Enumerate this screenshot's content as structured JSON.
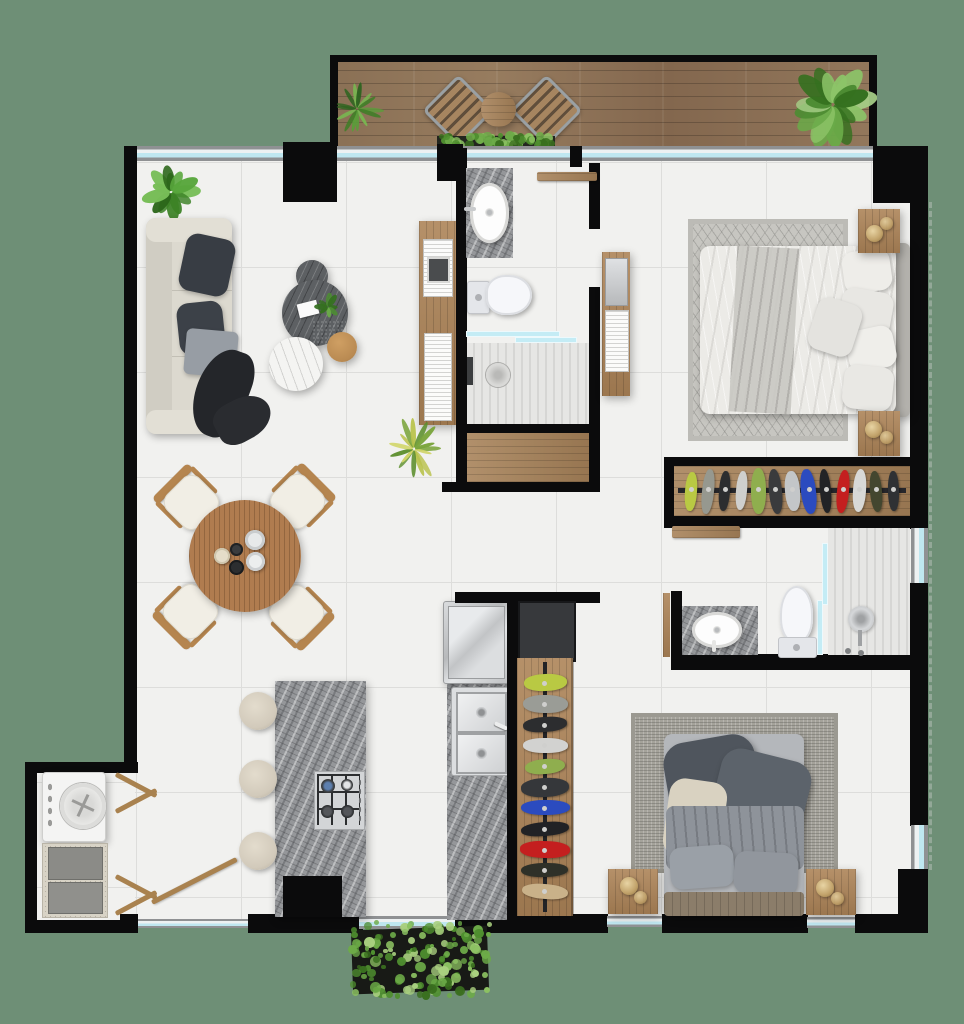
{
  "scene": {
    "type": "apartment-floor-plan",
    "view": "top-down-3d-render",
    "background_color": "#6e8f76",
    "rooms": [
      "balcony",
      "living-room",
      "dining-area",
      "kitchen",
      "laundry-room",
      "bathroom-1",
      "linen-closet",
      "master-bedroom",
      "master-wardrobe",
      "bathroom-2",
      "guest-bedroom",
      "guest-closet",
      "hallway"
    ]
  },
  "palette": {
    "exterior_green": "#6e8f76",
    "wall_black": "#0b0b0c",
    "tile_floor": "#f1f1ef",
    "tile_joint": "#dddddb",
    "deck_wood": "#8b7157",
    "interior_wood": "#ad8458",
    "window_glass": "#bfe7f0",
    "window_frame": "#8f9193",
    "granite_counter": "#95979a",
    "coffee_table_dark": "#5d6063",
    "marble_white": "#f4f4f2",
    "sofa_beige": "#dcd9cf",
    "pillow_dark": "#383d44",
    "bed_white": "#ecebe7",
    "bed_guest_dark": "#4f555d",
    "rug_master": "#c7c6c1",
    "rug_guest": "#a5a39b",
    "stainless_steel": "#c7c9cb",
    "lamp_gold": "#c2a36b",
    "plant_green": "#4d8c33",
    "accent_red_cloth": "#c41f1f",
    "accent_blue_cloth": "#2b4bbf"
  },
  "furniture": {
    "balcony": [
      "potted-palm",
      "bistro-chair",
      "bistro-table",
      "bistro-chair",
      "planter-strip",
      "potted-plant-large"
    ],
    "living": [
      "monstera-plant",
      "three-seat-sofa",
      "dark-pillows",
      "gray-pillow",
      "black-throw",
      "nesting-coffee-tables",
      "white-marble-table",
      "wood-side-table",
      "bookshelf-console",
      "spiky-plant"
    ],
    "dining": [
      "round-wood-table",
      "dining-chair-x4",
      "tableware"
    ],
    "kitchen": [
      "granite-island",
      "gas-cooktop",
      "bar-stool-x3",
      "fridge",
      "double-sink",
      "granite-counter"
    ],
    "laundry": [
      "top-load-washer",
      "utility-tank",
      "louver-doors"
    ],
    "bathroom1": [
      "granite-vanity",
      "oval-sink",
      "toilet",
      "glass-shower",
      "floor-drain"
    ],
    "master_bedroom": [
      "area-rug",
      "double-bed",
      "pillows",
      "nightstand-x2",
      "table-lamp-x2",
      "tv-console",
      "hanging-wardrobe"
    ],
    "bathroom2": [
      "granite-vanity",
      "oval-sink",
      "toilet",
      "glass-shower",
      "shower-head",
      "wood-shelf"
    ],
    "guest_bedroom": [
      "area-rug",
      "double-bed",
      "pillows",
      "nightstand-x2",
      "table-lamp-x2",
      "open-closet-rack",
      "dark-cabinet"
    ],
    "exterior": [
      "hedge-planter"
    ]
  },
  "wardrobe_rack_colors": [
    "#b9c943",
    "#96988f",
    "#2c2d2f",
    "#cfcfcd",
    "#8fae4e",
    "#3a3b3d",
    "#c3c6c8",
    "#2b4bbf",
    "#222326",
    "#c41f1f",
    "#d8d8d6",
    "#43462f",
    "#2f3134"
  ],
  "closet_rack_colors": [
    "#b9c943",
    "#9a9c96",
    "#2c2d2f",
    "#d2d2d0",
    "#8fae4e",
    "#35373a",
    "#2b4bbf",
    "#212225",
    "#c41f1f",
    "#2e3028",
    "#c9b189"
  ],
  "plants": {
    "balcony_left": {
      "leaves": 14,
      "thin": true,
      "seed": 11,
      "colors": [
        "#3f7d27",
        "#5b9c3a",
        "#79b551",
        "#2e6420"
      ]
    },
    "balcony_right": {
      "leaves": 18,
      "thin": false,
      "seed": 23,
      "colors": [
        "#4d8c33",
        "#6aaa48",
        "#8cc468",
        "#35701f",
        "#a5cd86"
      ]
    },
    "living_monstera": {
      "leaves": 13,
      "thin": false,
      "seed": 5,
      "colors": [
        "#3c8226",
        "#58a63c",
        "#77bd57",
        "#2c661a"
      ]
    },
    "spiky": {
      "leaves": 15,
      "thin": true,
      "seed": 31,
      "colors": [
        "#7aa43b",
        "#b9c24d",
        "#5d8f2e",
        "#d0d466"
      ]
    },
    "coffee_sprig": {
      "leaves": 8,
      "thin": false,
      "seed": 9,
      "colors": [
        "#4d8c33",
        "#6aaa48",
        "#35701f"
      ]
    }
  },
  "shrubs": {
    "hedge_box": {
      "dots": 150,
      "seed": 17,
      "colors": [
        "#4f8f2f",
        "#6dab48",
        "#8cc162",
        "#3a6f1f",
        "#a9d07f"
      ]
    },
    "planter_strip": {
      "dots": 60,
      "seed": 41,
      "colors": [
        "#4f8f2f",
        "#6dab48",
        "#8cc162",
        "#3a6f1f"
      ]
    }
  }
}
